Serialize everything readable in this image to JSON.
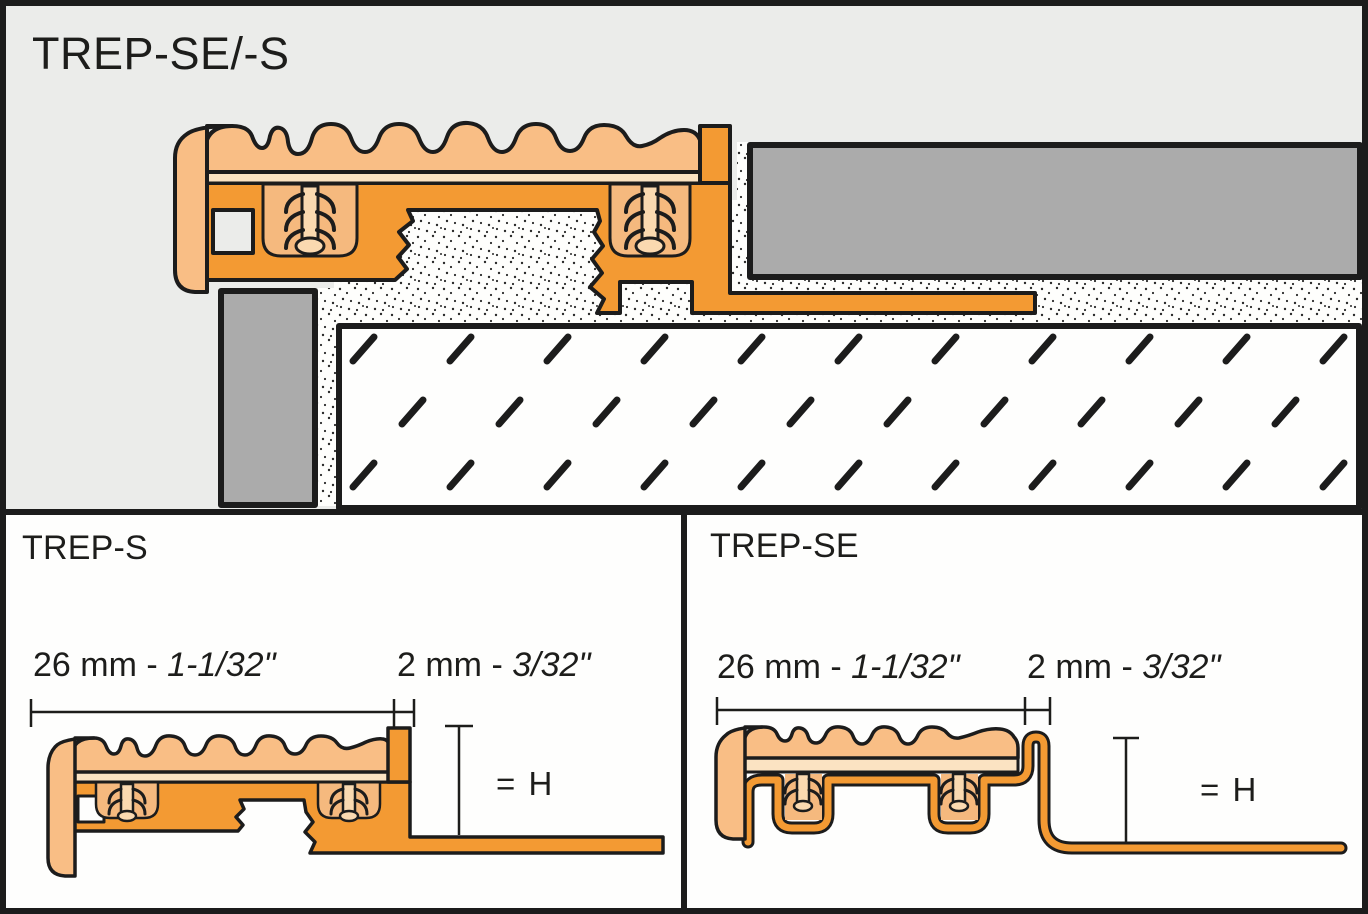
{
  "overview": {
    "title": "TREP-SE/-S"
  },
  "details": {
    "trep_s": {
      "title": "TREP-S",
      "width_dim": {
        "metric": "26 mm - ",
        "imperial": "1-1/32\""
      },
      "gap_dim": {
        "metric": "2 mm - ",
        "imperial": "3/32\""
      },
      "height_label": "= H"
    },
    "trep_se": {
      "title": "TREP-SE",
      "width_dim": {
        "metric": "26 mm - ",
        "imperial": "1-1/32\""
      },
      "gap_dim": {
        "metric": "2 mm - ",
        "imperial": "3/32\""
      },
      "height_label": "= H"
    }
  },
  "colors": {
    "profile_orange": "#F39A33",
    "tread_peach": "#F9BE85",
    "tread_base_light": "#FBE3C2",
    "slot_cavity": "#F5B97E",
    "fir_ribs": "#FAD9B0",
    "tile_gray": "#ABABAB",
    "overview_bg": "#EBECEA",
    "outline_black": "#1C1C1C",
    "drawing_white": "#FEFEFD"
  }
}
